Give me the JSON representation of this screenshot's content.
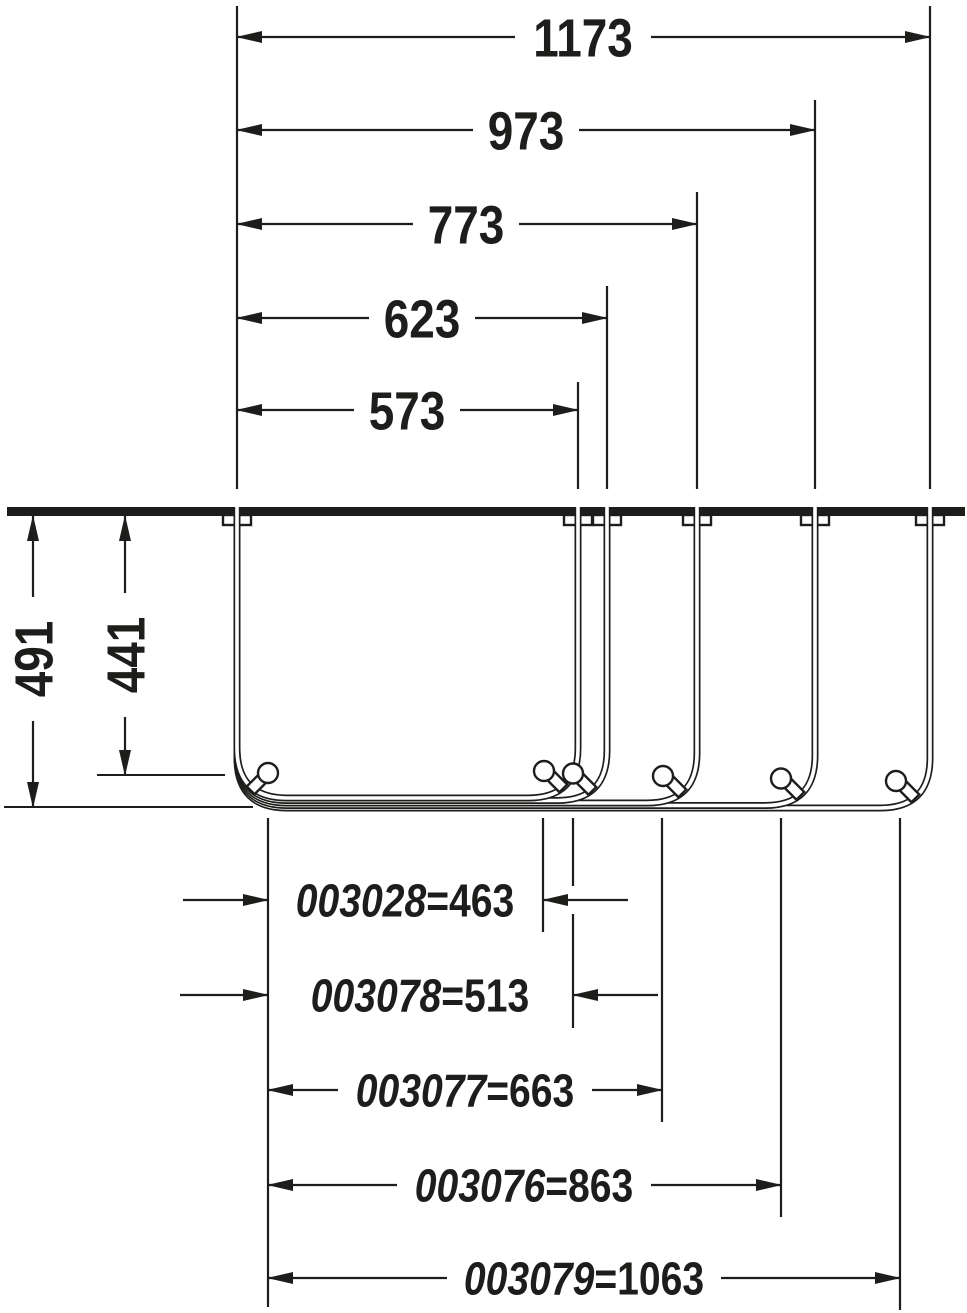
{
  "dims": {
    "top": [
      {
        "label": "1173"
      },
      {
        "label": "973"
      },
      {
        "label": "773"
      },
      {
        "label": "623"
      },
      {
        "label": "573"
      }
    ],
    "left": [
      {
        "label": "491"
      },
      {
        "label": "441"
      }
    ],
    "products": [
      {
        "code": "003028",
        "size": "=463"
      },
      {
        "code": "003078",
        "size": "=513"
      },
      {
        "code": "003077",
        "size": "=663"
      },
      {
        "code": "003076",
        "size": "=863"
      },
      {
        "code": "003079",
        "size": "=1063"
      }
    ]
  },
  "colors": {
    "line": "#1d1d1b",
    "background": "#ffffff"
  }
}
